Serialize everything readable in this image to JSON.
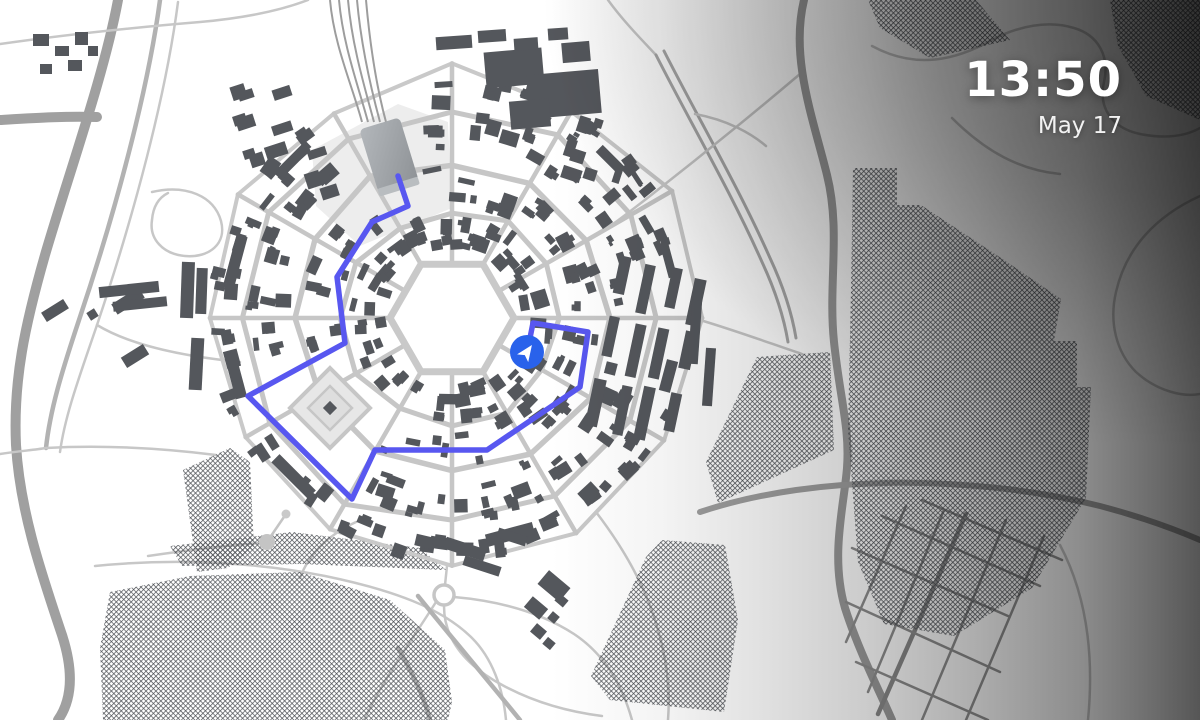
{
  "clock": {
    "time": "13:50",
    "date": "May 17"
  },
  "colors": {
    "background": "#ffffff",
    "building": "#54575c",
    "street": "#c6c6c6",
    "plaza_street": "#c9c9c9",
    "rural_thin": "#c7c7c7",
    "rural_med": "#b2b2b2",
    "rural_wide": "#a0a0a0",
    "river_road": "#9a9a9a",
    "river2_road": "#9f9f9f",
    "village_road": "#8f8f8f",
    "village_main_road": "#8a8a8a",
    "blvd_road": "#a8a8a8",
    "hatch": "#4b4e53",
    "plaza_fill": "#ededed",
    "diamond_fill": "#e7e7e7",
    "rail": "#9d9d9d",
    "station_light": "#b3b7bb",
    "station_dark": "#8e9296",
    "route": "#5857f0",
    "marker": "#2962eb",
    "marker_arrow": "#ffffff"
  },
  "city": {
    "center": {
      "x": 452,
      "y": 318
    },
    "plaza_radius": 62,
    "ring_radii": [
      108,
      158,
      210,
      246
    ],
    "ring_jitter": [
      5,
      6,
      8,
      10
    ],
    "radial_count": 12,
    "seed_rings": 77,
    "seed_buildings": 1234,
    "building_zones": [
      [
        70,
        100
      ],
      [
        114,
        150
      ],
      [
        164,
        202
      ],
      [
        214,
        240
      ]
    ]
  },
  "station": {
    "x": 389,
    "y": 155,
    "w": 42,
    "h": 66,
    "angle": -17,
    "plaza_points": "312,150 398,104 448,122 452,208 360,246 316,206",
    "rail_top_xs": [
      330,
      339,
      348,
      357,
      366
    ]
  },
  "diamond_plaza": {
    "cx": 330,
    "cy": 408,
    "r": 40,
    "inner_r": 22
  },
  "route": {
    "points": [
      [
        398,
        176
      ],
      [
        408,
        206
      ],
      [
        372,
        222
      ],
      [
        337,
        277
      ],
      [
        345,
        343
      ],
      [
        248,
        396
      ],
      [
        352,
        499
      ],
      [
        375,
        450
      ],
      [
        487,
        450
      ],
      [
        580,
        387
      ],
      [
        588,
        332
      ],
      [
        533,
        323
      ],
      [
        528,
        348
      ]
    ],
    "width": 5.5
  },
  "marker": {
    "x": 527,
    "y": 352,
    "r": 17,
    "heading": 35
  },
  "roundabout": {
    "x": 444,
    "y": 595,
    "r": 10
  },
  "pond": {
    "x": 267,
    "y": 542,
    "r": 8,
    "stem_x2": 286,
    "stem_y2": 514,
    "bulb_r": 4.5
  },
  "fields": [
    "853,168 897,168 897,205 921,205 1004,260 1061,299 1054,341 1077,341 1077,387 1091,387 1086,498 1032,588 954,636 884,624 858,562 848,430 851,290",
    "757,357 830,352 834,450 718,503 706,462",
    "662,540 725,545 738,620 724,712 610,700 591,676 646,557",
    "100,648 110,592 190,576 300,572 390,600 445,650 452,702 448,720 103,720",
    "170,546 292,532 420,548 446,570 302,564 182,566",
    "183,470 230,448 250,462 254,548 228,568 197,572",
    "868,0 976,0 1010,40 930,58 880,28",
    "1110,0 1200,0 1200,120 1146,96 1118,46"
  ],
  "roads": [
    {
      "d": "M118,0 C104,75 70,170 45,255 C25,325 13,380 16,445 C20,512 42,575 62,635 C74,672 72,700 58,720",
      "cls": "wide"
    },
    {
      "d": "M0,120 C34,118 64,116 97,117",
      "cls": "wide"
    },
    {
      "d": "M160,0 C148,90 116,210 79,320 C62,371 50,410 46,448",
      "cls": "med"
    },
    {
      "d": "M178,2 C166,95 134,215 97,325 C80,375 65,415 60,452",
      "cls": "thin"
    },
    {
      "d": "M0,44 C70,34 140,27 200,22 C245,18 282,10 308,0",
      "cls": "thin"
    },
    {
      "d": "M152,192 C186,184 214,196 221,221 C227,244 209,258 185,256 C163,254 149,239 152,220 C153,208 158,198 168,193",
      "cls": "thin"
    },
    {
      "d": "M46,448 C100,445 160,448 216,455",
      "cls": "thin"
    },
    {
      "d": "M0,454 C20,451 34,450 46,448",
      "cls": "thin"
    },
    {
      "d": "M97,325 C130,345 180,356 240,362",
      "cls": "thin"
    },
    {
      "d": "M608,0 C624,22 642,40 656,55",
      "cls": "thin"
    },
    {
      "d": "M656,55 C690,122 730,190 762,262 C776,292 784,318 788,342",
      "cls": "blvd"
    },
    {
      "d": "M664,51 C698,118 738,186 770,258 C784,288 792,314 796,338",
      "cls": "blvd"
    },
    {
      "d": "M800,74 C748,118 696,160 650,196 C632,210 616,222 602,232",
      "cls": "thin"
    },
    {
      "d": "M695,114 C728,120 752,134 766,146",
      "cls": "thin"
    },
    {
      "d": "M804,0 C790,58 813,118 827,175 C841,231 828,284 834,342 C840,399 850,428 847,468 C844,506 830,556 845,608 C859,652 880,692 892,720",
      "cls": "river"
    },
    {
      "d": "M700,512 C820,472 980,476 1100,506 C1138,516 1172,528 1200,540",
      "cls": "river2"
    },
    {
      "d": "M700,320 C740,332 772,344 802,354",
      "cls": "thin"
    },
    {
      "d": "M872,46 C916,70 956,60 992,40 C1018,26 1048,20 1074,28 C1098,35 1110,56 1104,82 C1098,108 1112,128 1140,134 C1166,139 1186,136 1200,128",
      "cls": "thin"
    },
    {
      "d": "M952,118 C986,152 1020,170 1060,174",
      "cls": "thin"
    },
    {
      "d": "M1200,196 C1156,216 1126,248 1116,292 C1109,322 1116,352 1136,372 C1158,392 1184,397 1200,394",
      "cls": "thin"
    },
    {
      "d": "M1060,545 C1088,598 1094,658 1088,720",
      "cls": "thin"
    },
    {
      "d": "M95,566 C175,558 255,562 325,576 C393,590 442,608 472,638 C492,658 503,688 506,720",
      "cls": "thin"
    },
    {
      "d": "M148,556 C196,549 232,545 260,543",
      "cls": "thin"
    },
    {
      "d": "M300,578 C308,556 326,536 356,522",
      "cls": "thin"
    },
    {
      "d": "M447,566 L445,585",
      "cls": "thin"
    },
    {
      "d": "M444,606 C444,640 466,666 504,686 C536,703 570,712 602,716",
      "cls": "thin"
    },
    {
      "d": "M436,602 C412,640 384,678 364,720",
      "cls": "thin"
    },
    {
      "d": "M454,597 C500,601 540,612 574,634 C604,654 622,684 632,720",
      "cls": "thin"
    },
    {
      "d": "M596,512 C622,546 646,586 658,630 C668,664 670,694 668,720",
      "cls": "thin"
    },
    {
      "d": "M418,596 C452,638 486,678 520,720",
      "cls": "med"
    },
    {
      "d": "M398,648 C412,672 424,696 430,720",
      "cls": "med"
    },
    {
      "d": "M966,514 L878,714",
      "cls": "villageMain"
    },
    {
      "d": "M906,506 L846,642",
      "cls": "village"
    },
    {
      "d": "M944,510 L868,692",
      "cls": "village"
    },
    {
      "d": "M1006,520 L922,720",
      "cls": "village"
    },
    {
      "d": "M1044,536 L966,720",
      "cls": "village"
    },
    {
      "d": "M852,548 L1008,616",
      "cls": "village"
    },
    {
      "d": "M846,602 L1000,672",
      "cls": "village"
    },
    {
      "d": "M856,662 L988,720",
      "cls": "village"
    },
    {
      "d": "M882,516 L1040,586",
      "cls": "village"
    },
    {
      "d": "M922,500 L1062,560",
      "cls": "village"
    }
  ],
  "annex": {
    "x0": 600,
    "y0": 262,
    "cols": 4,
    "rows": 3,
    "dx": 26,
    "dy": 60,
    "rot": 12,
    "cx": 648,
    "cy": 345,
    "seed": 555
  },
  "suburbs": [
    {
      "x": 236,
      "y": 92,
      "w": 96,
      "h": 108,
      "rot": -18,
      "n": 13
    },
    {
      "x": 560,
      "y": 118,
      "w": 78,
      "h": 66,
      "rot": 18,
      "n": 8
    }
  ],
  "extra_buildings": [
    [
      42,
      305,
      26,
      11,
      -32
    ],
    [
      112,
      295,
      32,
      12,
      -32
    ],
    [
      88,
      310,
      9,
      9,
      -32
    ],
    [
      122,
      350,
      26,
      12,
      -32
    ],
    [
      33,
      34,
      16,
      12,
      0
    ],
    [
      55,
      46,
      14,
      10,
      0
    ],
    [
      75,
      32,
      13,
      13,
      0
    ],
    [
      40,
      64,
      12,
      10,
      0
    ],
    [
      68,
      60,
      14,
      11,
      0
    ],
    [
      88,
      46,
      10,
      10,
      0
    ],
    [
      99,
      284,
      60,
      11,
      -6
    ],
    [
      113,
      299,
      54,
      10,
      -6
    ],
    [
      181,
      262,
      13,
      56,
      2
    ],
    [
      196,
      268,
      11,
      46,
      2
    ],
    [
      190,
      338,
      13,
      52,
      3
    ],
    [
      444,
      543,
      42,
      12,
      18
    ],
    [
      463,
      561,
      38,
      10,
      18
    ],
    [
      497,
      532,
      30,
      10,
      18
    ],
    [
      540,
      577,
      28,
      18,
      40
    ],
    [
      526,
      601,
      20,
      14,
      40
    ],
    [
      556,
      596,
      11,
      9,
      40
    ],
    [
      549,
      613,
      9,
      9,
      40
    ],
    [
      532,
      626,
      13,
      11,
      40
    ],
    [
      544,
      639,
      10,
      9,
      40
    ],
    [
      690,
      300,
      10,
      64,
      4
    ],
    [
      704,
      348,
      10,
      58,
      4
    ],
    [
      485,
      50,
      58,
      36,
      -5
    ],
    [
      528,
      72,
      72,
      44,
      -5
    ],
    [
      510,
      100,
      40,
      28,
      -5
    ],
    [
      562,
      42,
      28,
      20,
      -5
    ],
    [
      436,
      36,
      36,
      13,
      -4
    ],
    [
      478,
      30,
      28,
      12,
      -4
    ],
    [
      514,
      38,
      24,
      12,
      -4
    ],
    [
      548,
      28,
      20,
      12,
      -4
    ]
  ]
}
